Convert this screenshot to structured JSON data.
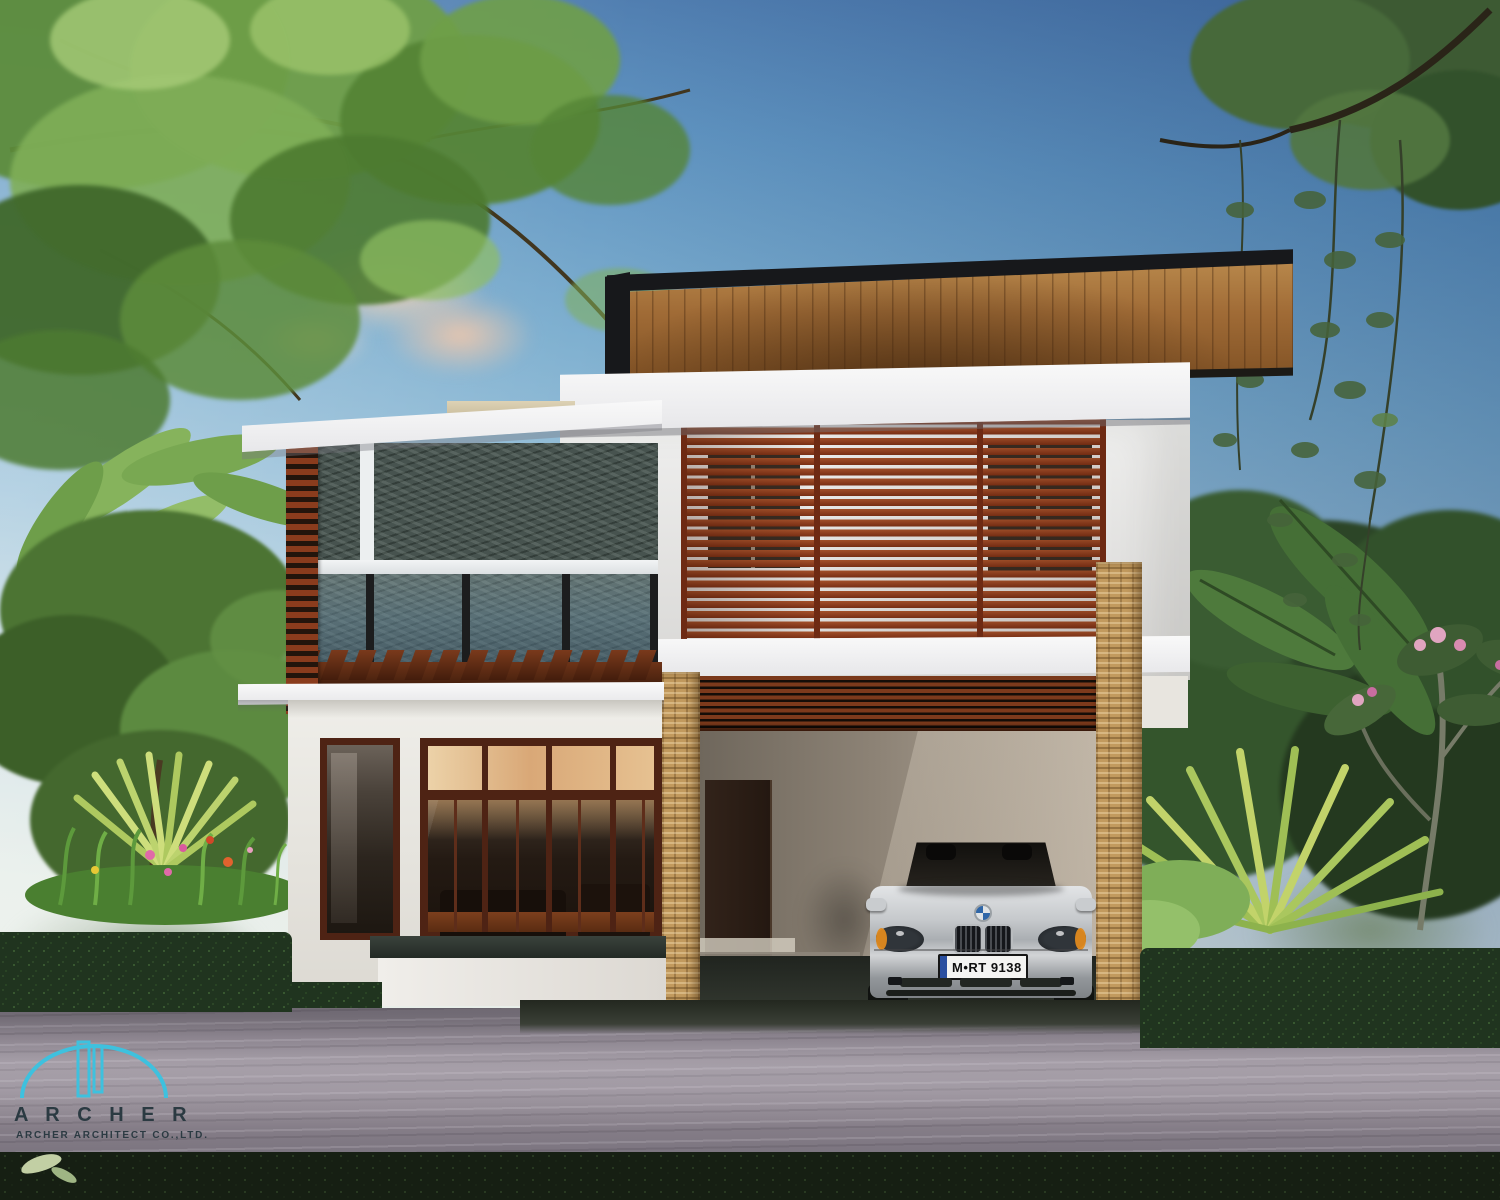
{
  "scene": {
    "description": "Daytime architectural rendering of a modern two-storey tropical house with timber louver screens, dark stone feature wall, glass balcony, stone-clad carport pillars, a silver convertible parked in the carport, lush gardens, hedges and an asphalt road in front."
  },
  "logo": {
    "name": "A R C H E R",
    "subtitle": "ARCHER ARCHITECT CO.,LTD.",
    "mark": "arch-and-towers-icon",
    "cyan": "#3ec1de",
    "text_color": "#2b3a42"
  },
  "car": {
    "license_plate": "M•RT 9138",
    "brand_mark": "bmw-roundel-icon",
    "body_color": "#c3c6c9"
  },
  "palette": {
    "sky_top": "#466fa5",
    "sky_horizon": "#edf0ea",
    "cloud_pink": "#f3cfae",
    "foliage_light": "#8fbe62",
    "foliage_dark": "#2c4a24",
    "roof_soffit_wood": "#a06b36",
    "roof_edge": "#17181b",
    "louver_wood": "#9c4a24",
    "white_trim": "#f4f4f5",
    "stone_feature_wall": "#47534f",
    "stone_pillar": "#c29a5e",
    "window_frame_wood": "#4e2314",
    "interior_warm_glow": "#e3b98b",
    "carport_wall": "#998e80",
    "carport_floor": "#2b2f2a",
    "road": "#8b8390",
    "hedge": "#2a3d26"
  }
}
